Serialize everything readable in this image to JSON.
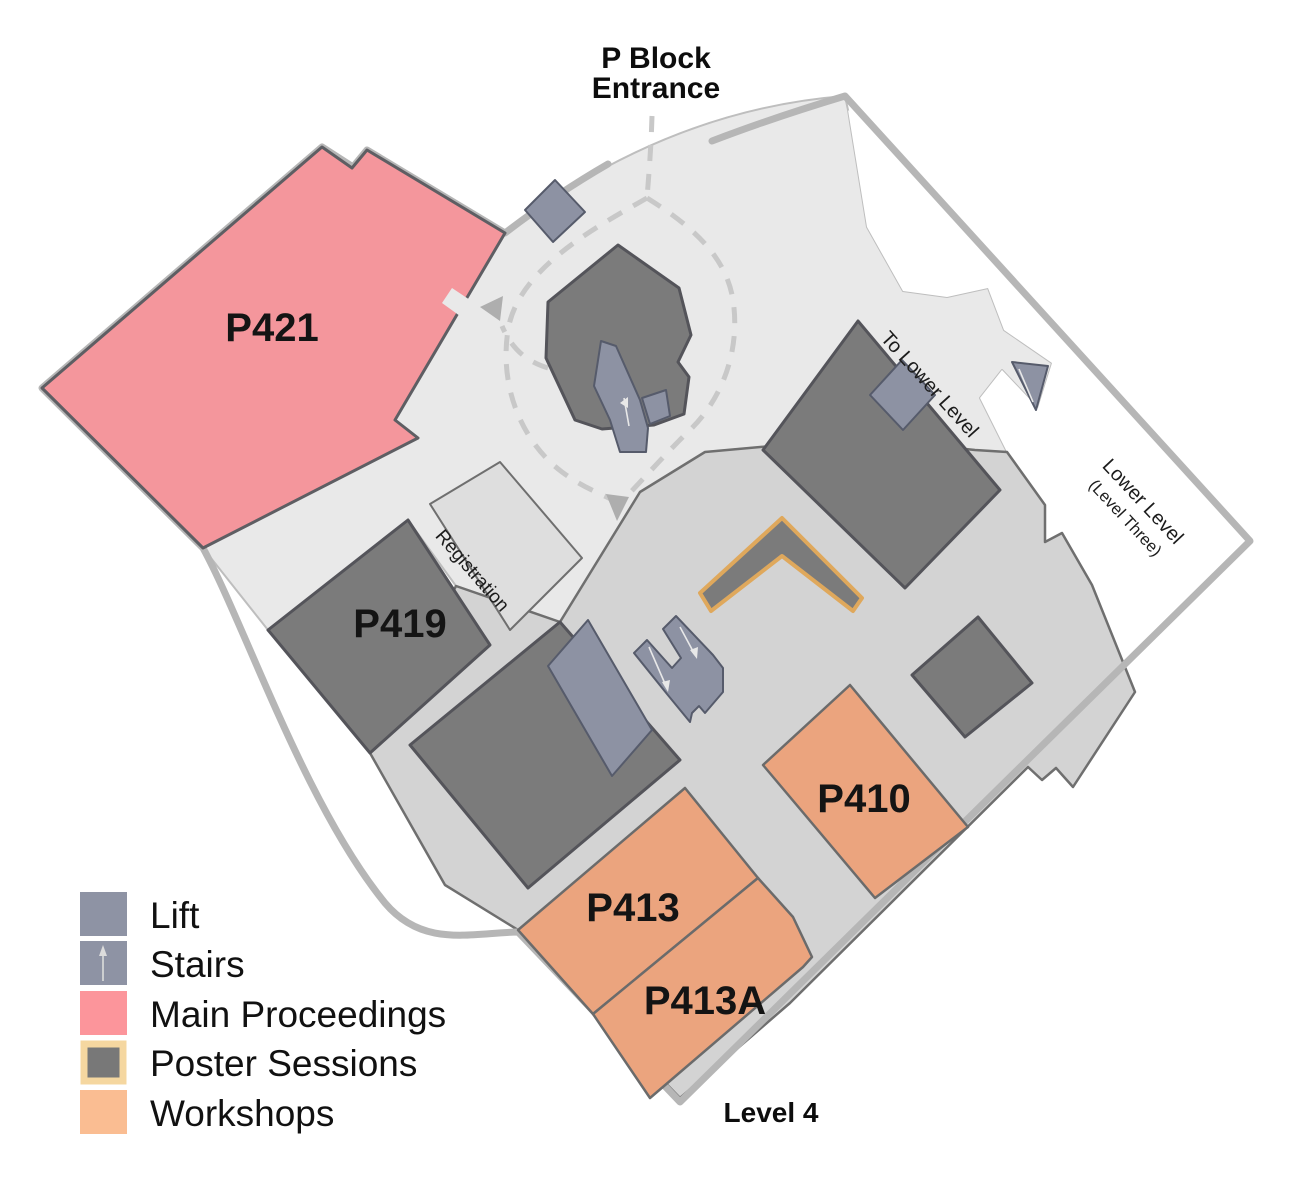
{
  "map": {
    "title_line1": "P Block",
    "title_line2": "Entrance",
    "level_label": "Level 4",
    "rooms": {
      "p421": "P421",
      "p419": "P419",
      "p410": "P410",
      "p413": "P413",
      "p413a": "P413A"
    },
    "annotations": {
      "registration": "Registration",
      "to_lower_level": "To Lower Level",
      "lower_level": "Lower Level",
      "lower_level_sub": "(Level Three)"
    }
  },
  "legend": {
    "items": [
      {
        "label": "Lift",
        "color": "#8e93a4"
      },
      {
        "label": "Stairs",
        "color": "#8e93a4"
      },
      {
        "label": "Main Proceedings",
        "color": "#fc959b"
      },
      {
        "label": "Poster Sessions",
        "color": "#787878",
        "border": "#f5d7a0"
      },
      {
        "label": "Workshops",
        "color": "#fabd92"
      }
    ]
  },
  "colors": {
    "main_proceedings": "#f4969c",
    "workshops": "#eba47e",
    "poster_room": "#7b7b7b",
    "poster_outline": "#dfa85c",
    "lift_stairs": "#8d92a3"
  }
}
